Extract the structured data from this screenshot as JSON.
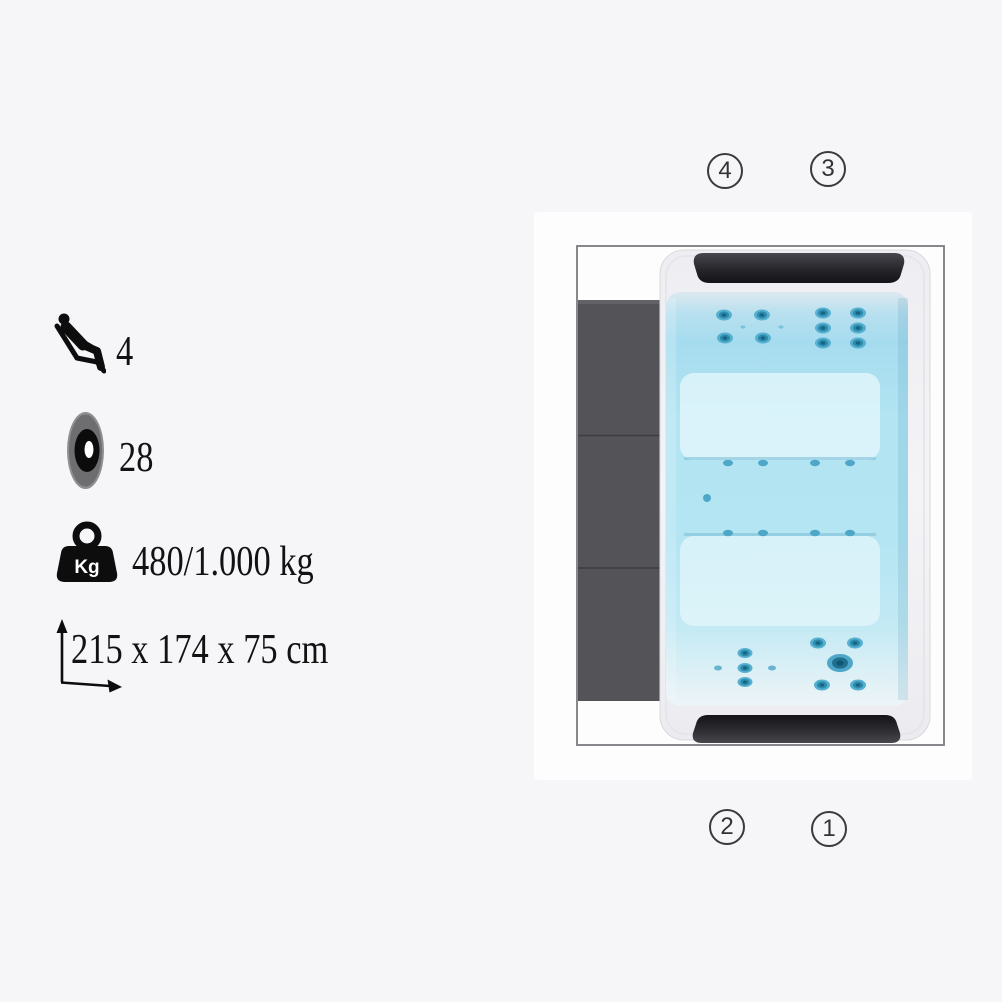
{
  "page": {
    "background": "#f6f6f8"
  },
  "specs": {
    "seats": {
      "icon": "seat-icon",
      "value": "4"
    },
    "jets": {
      "icon": "jet-icon",
      "value": "28"
    },
    "weight": {
      "icon": "weight-icon",
      "badge": "Kg",
      "value": "480/1.000 kg"
    },
    "dimensions": {
      "icon": "dimensions-icon",
      "value": "215 x 174 x 75 cm"
    }
  },
  "diagram": {
    "description": "hot tub top view",
    "markers": [
      {
        "label": "4",
        "position": "top-left"
      },
      {
        "label": "3",
        "position": "top-right"
      },
      {
        "label": "2",
        "position": "bottom-left"
      },
      {
        "label": "1",
        "position": "bottom-right"
      }
    ],
    "colors": {
      "water": "#b3e4f2",
      "water_bench": "#e0f5fa",
      "jet": "#2d8cae",
      "cabinet_panel": "#545458",
      "headrest": "#222226",
      "frame_line": "#7b7b80"
    }
  }
}
